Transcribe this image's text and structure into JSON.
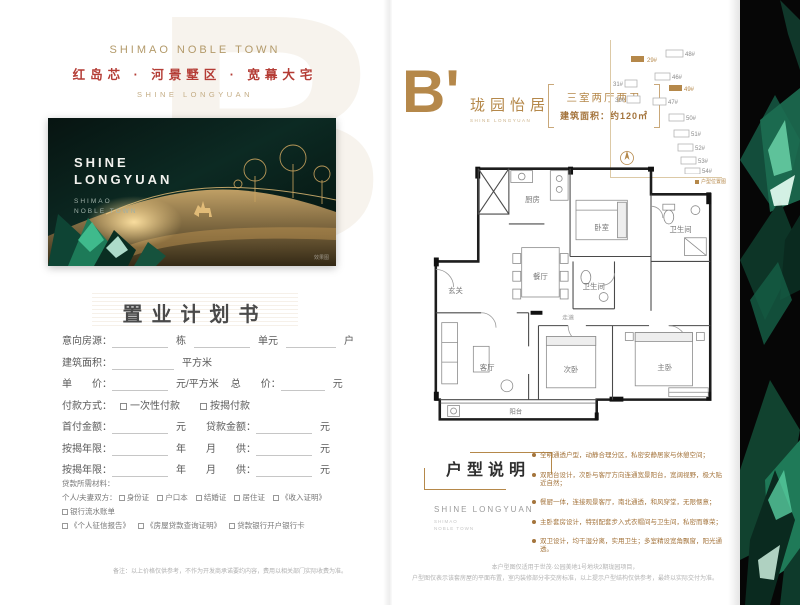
{
  "brand": {
    "name_en": "SHIMAO NOBLE TOWN",
    "tagline": "红岛芯 · 河景墅区 · 宽幕大宅",
    "sub_en": "SHINE LONGYUAN"
  },
  "watermark_letter": "B'",
  "hero": {
    "title1": "SHINE",
    "title2": "LONGYUAN",
    "sub1": "SHIMAO",
    "sub2": "NOBLE TOWN",
    "credit": "效果图"
  },
  "form": {
    "title": "置业计划书",
    "row1": [
      "意向房源：",
      "栋",
      "单元",
      "户"
    ],
    "row2": [
      "建筑面积：",
      "平方米"
    ],
    "row3": [
      "单　　价：",
      "元/平方米",
      "总　　价：",
      "元"
    ],
    "row4": {
      "label": "付款方式：",
      "opt1": "一次性付款",
      "opt2": "按揭付款"
    },
    "row5": [
      "首付金额：",
      "元",
      "贷款金额：",
      "元"
    ],
    "row6": [
      "按揭年限：",
      "年",
      "月　　供：",
      "元"
    ],
    "row7": [
      "按揭年限：",
      "年",
      "月　　供：",
      "元"
    ]
  },
  "materials": {
    "heading": "贷款所需材料：",
    "line1_label": "个人/夫妻双方：",
    "items1": [
      "身份证",
      "户口本",
      "结婚证",
      "居住证",
      "《收入证明》",
      "银行流水账单"
    ],
    "items2": [
      "《个人征信报告》",
      "《房屋贷款查询证明》",
      "贷款银行开户银行卡"
    ]
  },
  "unit": {
    "letter": "B'",
    "name_cn": "珑园怡居",
    "name_en": "SHINE LONGYUAN",
    "spec_rooms": "三室两厅两卫",
    "spec_area": "建筑面积：约120㎡"
  },
  "siteplan": {
    "legend": "户型位置图",
    "buildings": [
      "29#",
      "48#",
      "46#",
      "49#",
      "31#",
      "32#",
      "47#",
      "50#",
      "51#",
      "52#",
      "53#",
      "54#"
    ]
  },
  "floorplan": {
    "rooms": {
      "kitchen": "厨房",
      "dining": "餐厅",
      "hall": "玄关",
      "bath1": "卫生间",
      "bath2": "卫生间",
      "bed_top": "卧室",
      "bed_mid": "次卧",
      "master": "主卧",
      "living": "客厅",
      "balcony": "阳台",
      "corridor": "走道"
    }
  },
  "description": {
    "title": "户型说明",
    "brand_en": "SHINE LONGYUAN",
    "brand_sub1": "SHIMAO",
    "brand_sub2": "NOBLE TOWN",
    "bullets": [
      "全明通透户型，动静合理分区，私密安静居家与休憩空间；",
      "双阳台设计，次卧与客厅方向连通宽景阳台，宽阔视野，极大贴近自然；",
      "餐厨一体，连接观景客厅，南北通透，和风穿堂，无限惬意；",
      "主卧套房设计，特别配套步入式衣帽间与卫生间，私密而尊荣；",
      "双卫设计，均干湿分离，实用卫生；多室精设宽角飘窗，阳光通透。"
    ]
  },
  "footnotes": {
    "left": "备注：以上价格仅供参考，不作为开发商承诺要约内容，费用以相关部门实际收费为准。",
    "right1": "本户型图仅适用于世茂·公园美地1号地块2期珑园项目，",
    "right2": "户型图仅表示该套房屋的平面布置，室内装修部分非交房标准，以上提示户型结构仅供参考，最终以实际交付为准。"
  },
  "side_panel": {
    "vertical_text": "SHINE"
  },
  "colors": {
    "gold": "#b5884a",
    "red": "#b43c35",
    "emerald": "#1f7a58",
    "panel_black": "#060606"
  }
}
